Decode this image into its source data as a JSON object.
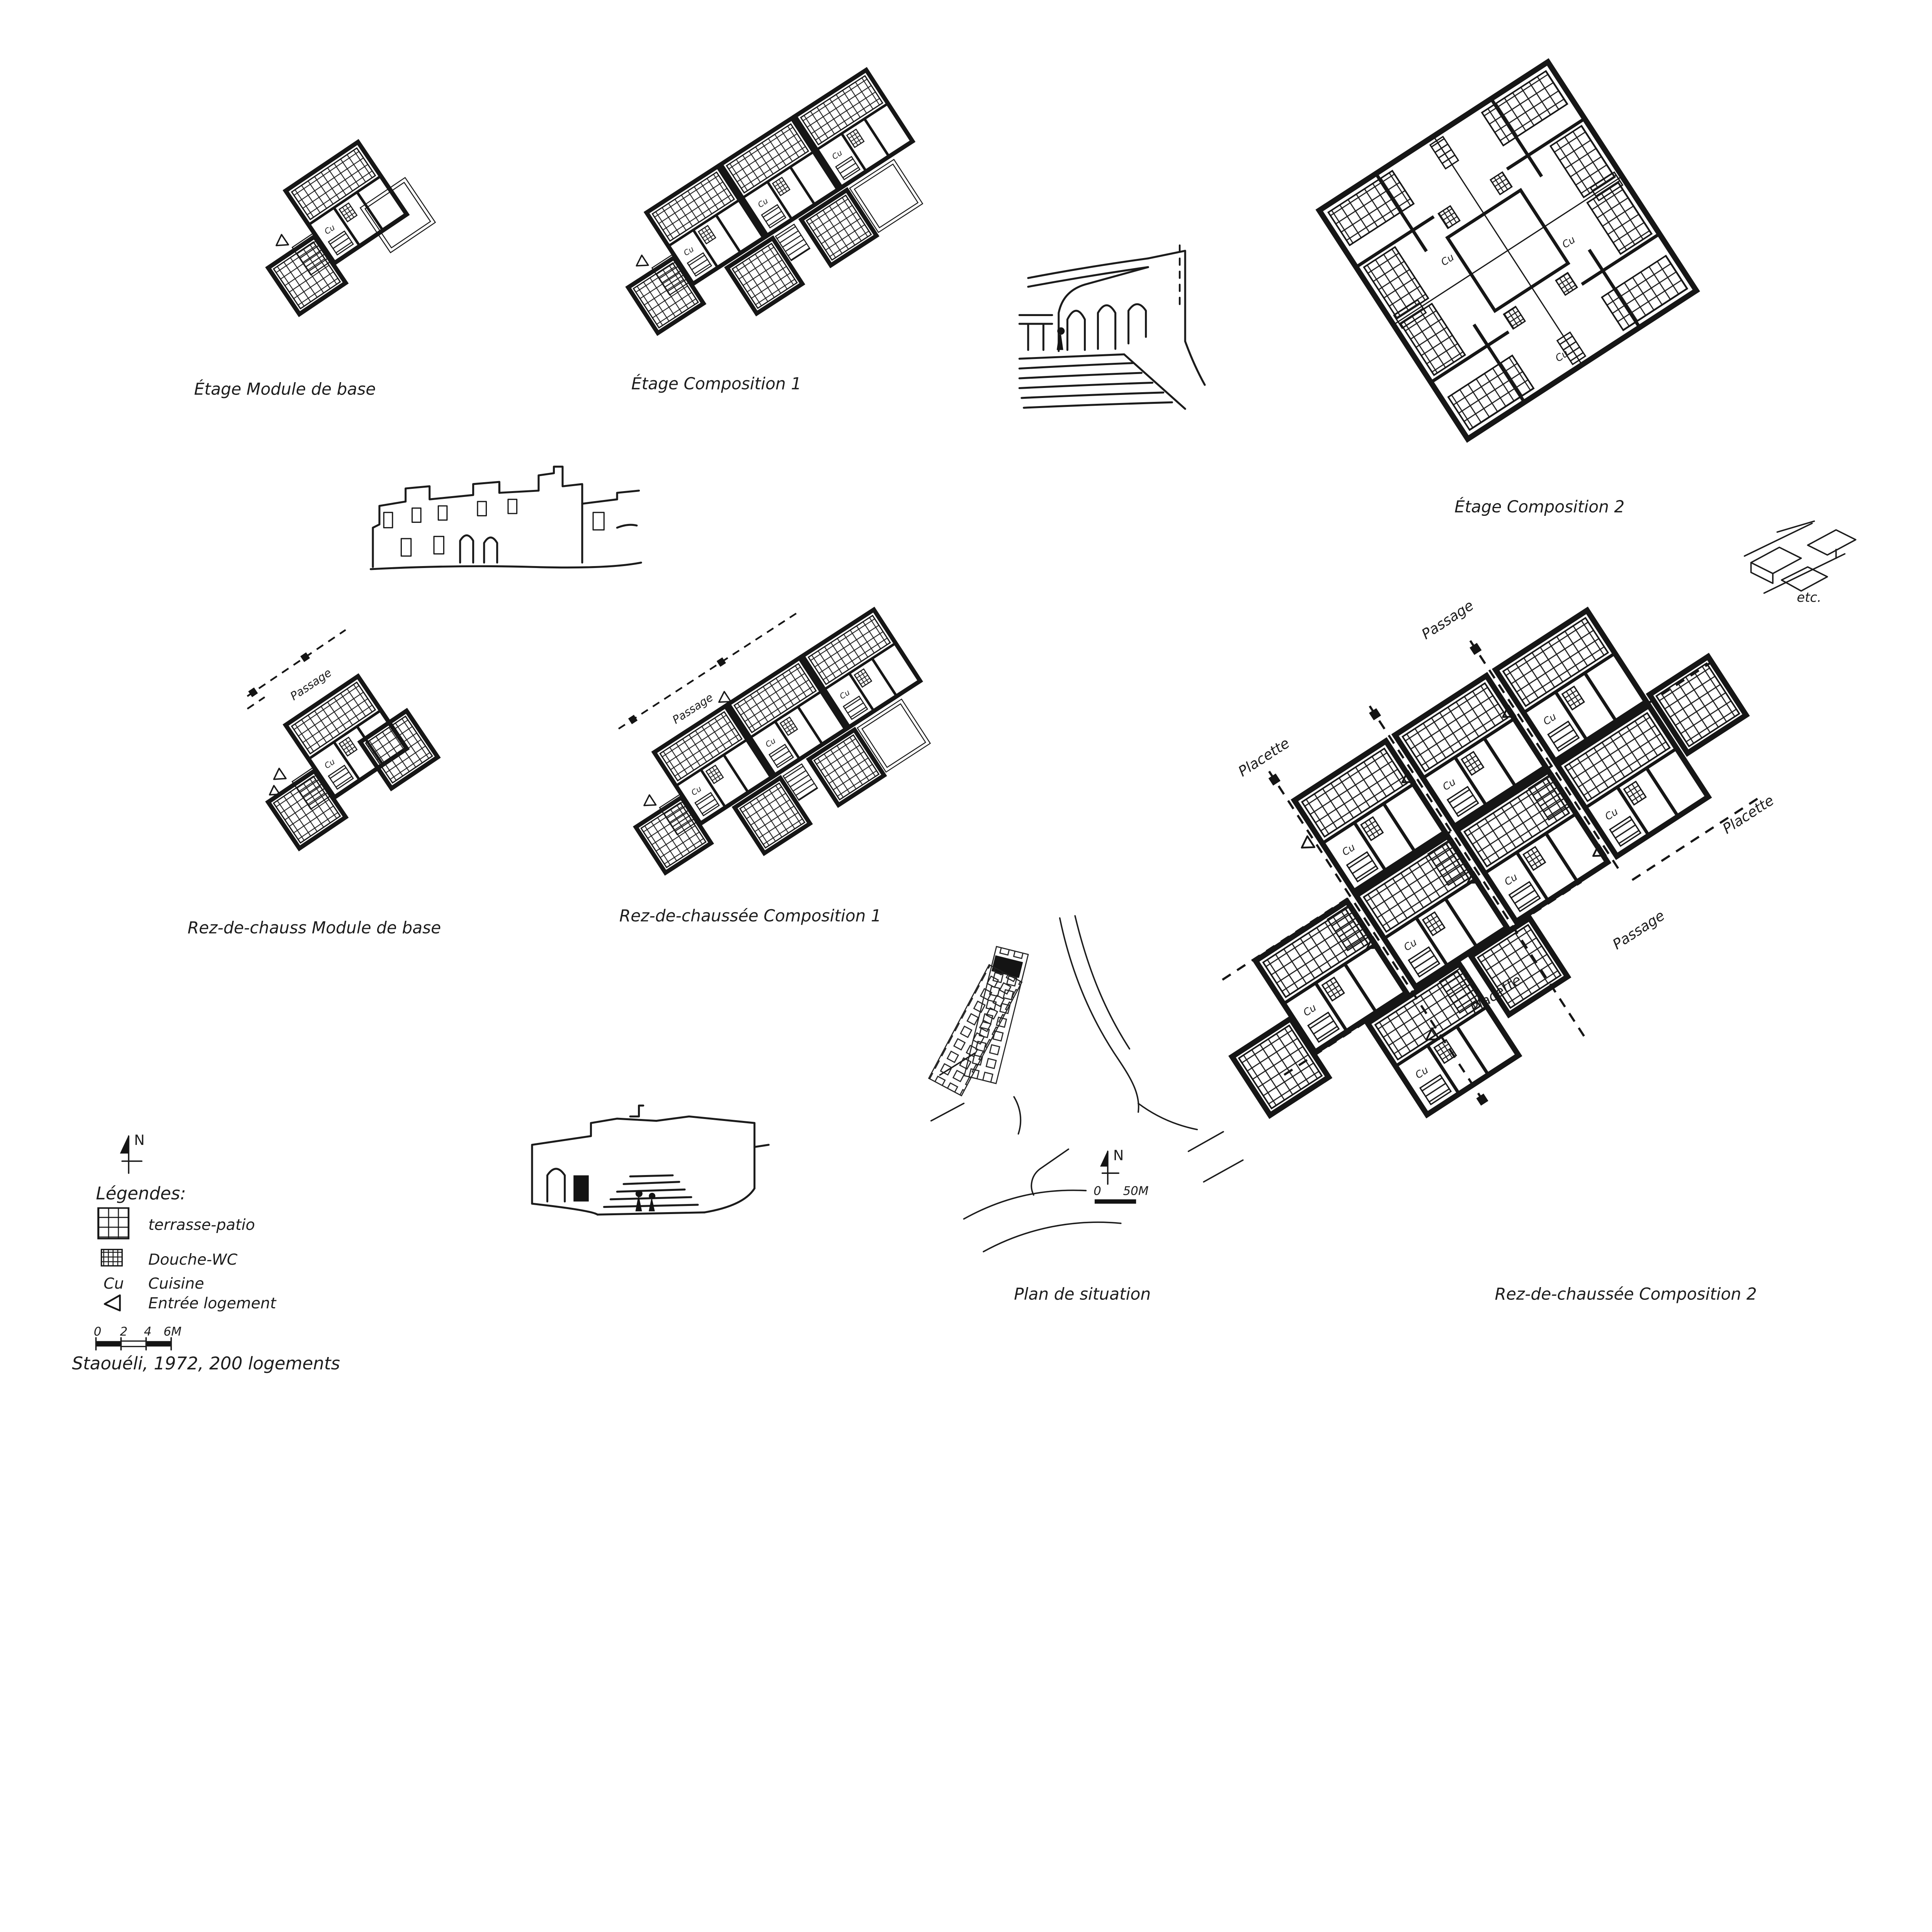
{
  "sheet": {
    "title": "Staouéli, 1972, 200 logements",
    "paper_color": "#ffffff",
    "ink_color": "#1c1c1c"
  },
  "captions": {
    "etage_module": "Étage   Module de base",
    "etage_comp1": "Étage  Composition 1",
    "etage_comp2": "Étage   Composition 2",
    "rdc_module": "Rez-de-chauss  Module de base",
    "rdc_comp1": "Rez-de-chaussée   Composition 1",
    "rdc_comp2": "Rez-de-chaussée  Composition 2",
    "site": "Plan de situation",
    "etc_note": "etc."
  },
  "plan_labels": {
    "passage": "Passage",
    "placette": "Placette",
    "cuisine": "Cu"
  },
  "legend": {
    "heading": "Légendes:",
    "items": [
      {
        "symbol": "large-grid-swatch",
        "label": "terrasse-patio"
      },
      {
        "symbol": "dense-grid-swatch",
        "label": "Douche-WC"
      },
      {
        "symbol": "Cu",
        "label": "Cuisine"
      },
      {
        "symbol": "entry-triangle",
        "label": "Entrée logement"
      }
    ]
  },
  "scale_bar": {
    "ticks": [
      "0",
      "2",
      "4",
      "6M"
    ]
  },
  "site_plan": {
    "north_label": "N",
    "scale_ticks": [
      "0",
      "50M"
    ]
  },
  "north_label": "N"
}
